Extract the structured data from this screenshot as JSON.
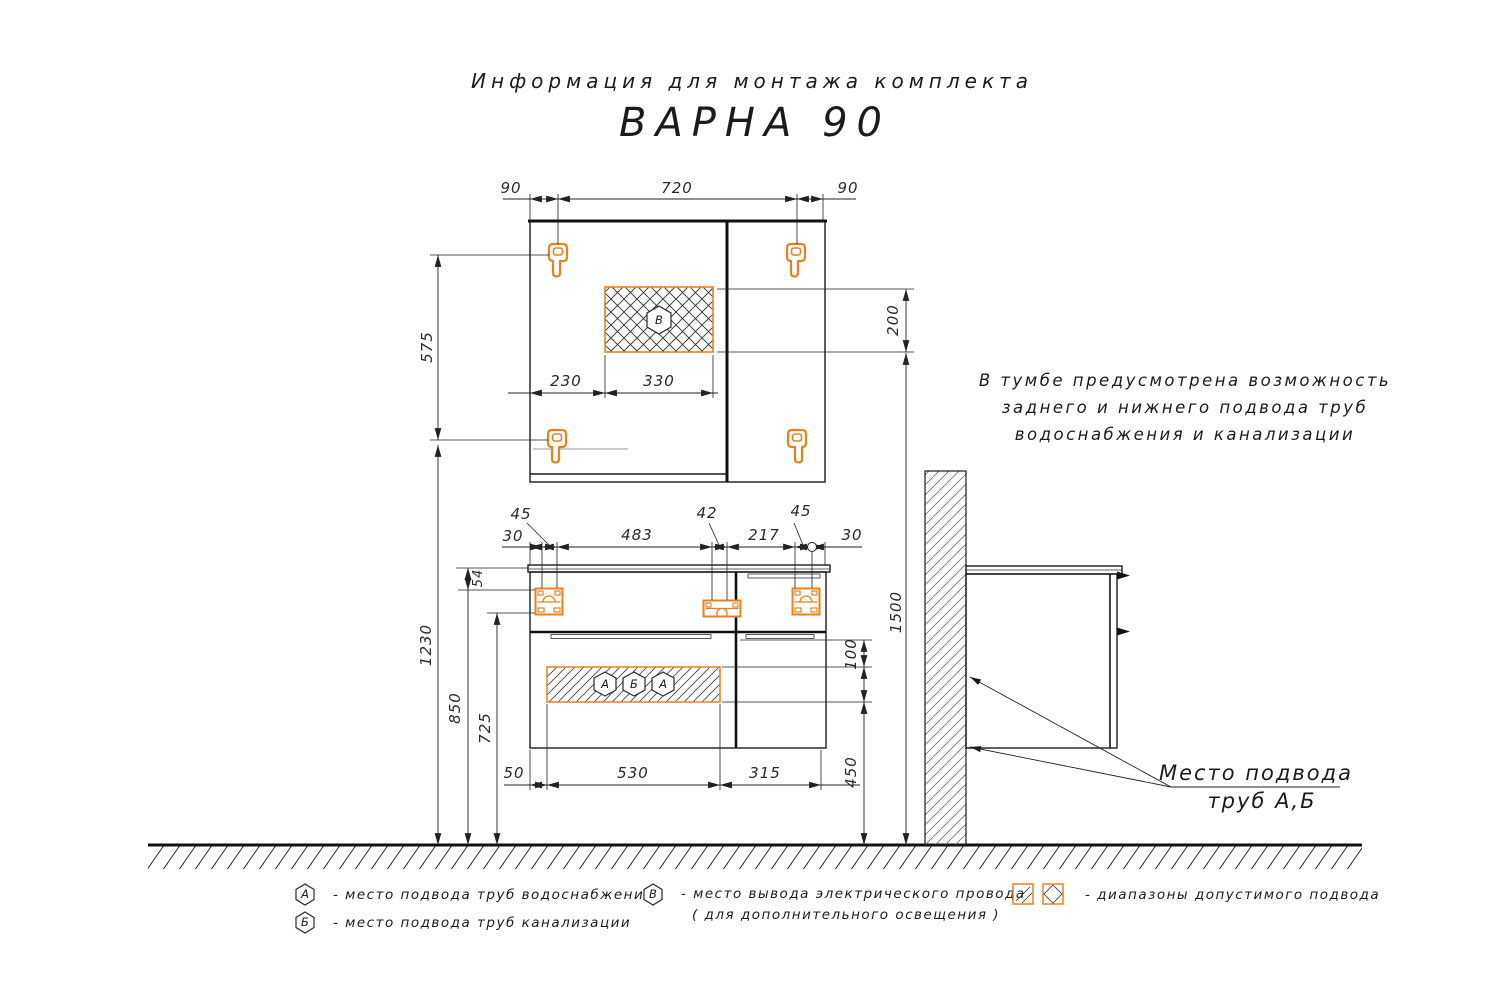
{
  "title": {
    "subtitle": "Информация для монтажа комплекта",
    "product": "ВАРНА 90"
  },
  "note": {
    "line1": "В тумбе предусмотрена возможность",
    "line2": "заднего и нижнего подвода труб",
    "line3": "водоснабжения и канализации"
  },
  "callout": {
    "line1": "Место подвода",
    "line2": "труб А,Б"
  },
  "markers": {
    "a": "А",
    "b": "Б",
    "v": "В"
  },
  "dims": {
    "top_left": "90",
    "top_center": "720",
    "top_right": "90",
    "hooks_span": "575",
    "hooks_to_floor": "1230",
    "electric_offset_left": "230",
    "electric_width": "330",
    "electric_zone_height": "200",
    "wall_zone_height": "1500",
    "counter_to_bracket": "54",
    "counter_height": "850",
    "bracket_to_floor": "725",
    "edge_left": "30",
    "bracket_left": "45",
    "brackets_span": "483",
    "bracket_mid": "42",
    "mid_to_right": "217",
    "bracket_right": "45",
    "edge_right": "30",
    "pipe_offset_left": "50",
    "pipe_zone_width": "530",
    "pipe_to_edge": "315",
    "pipe_zone_top_gap": "100",
    "pipe_zone_floor": "450"
  },
  "legend": {
    "a_text": "-  место подвода труб водоснабжения",
    "b_text": "-  место подвода труб канализации",
    "v_text": "-  место вывода электрического провода",
    "v_text2": "( для дополнительного освещения )",
    "ranges_text": "-  диапазоны допустимого подвода"
  },
  "colors": {
    "accent": "#E8821E",
    "line": "#1c1c1c"
  }
}
